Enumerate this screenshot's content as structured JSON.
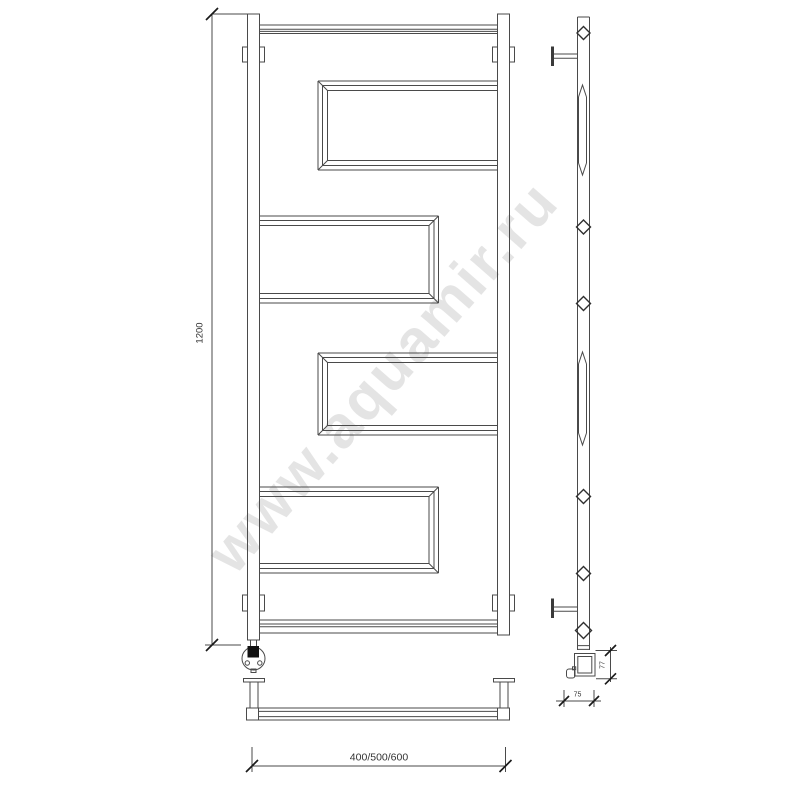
{
  "watermark": {
    "text": "www.aquamir.ru"
  },
  "dimensions": {
    "height": "1200",
    "width": "400/500/600",
    "element_height": "77",
    "depth": "75"
  },
  "colors": {
    "line": "#4a4a4a",
    "text": "#333333",
    "watermark": "#cbcbcb",
    "background": "#ffffff"
  }
}
